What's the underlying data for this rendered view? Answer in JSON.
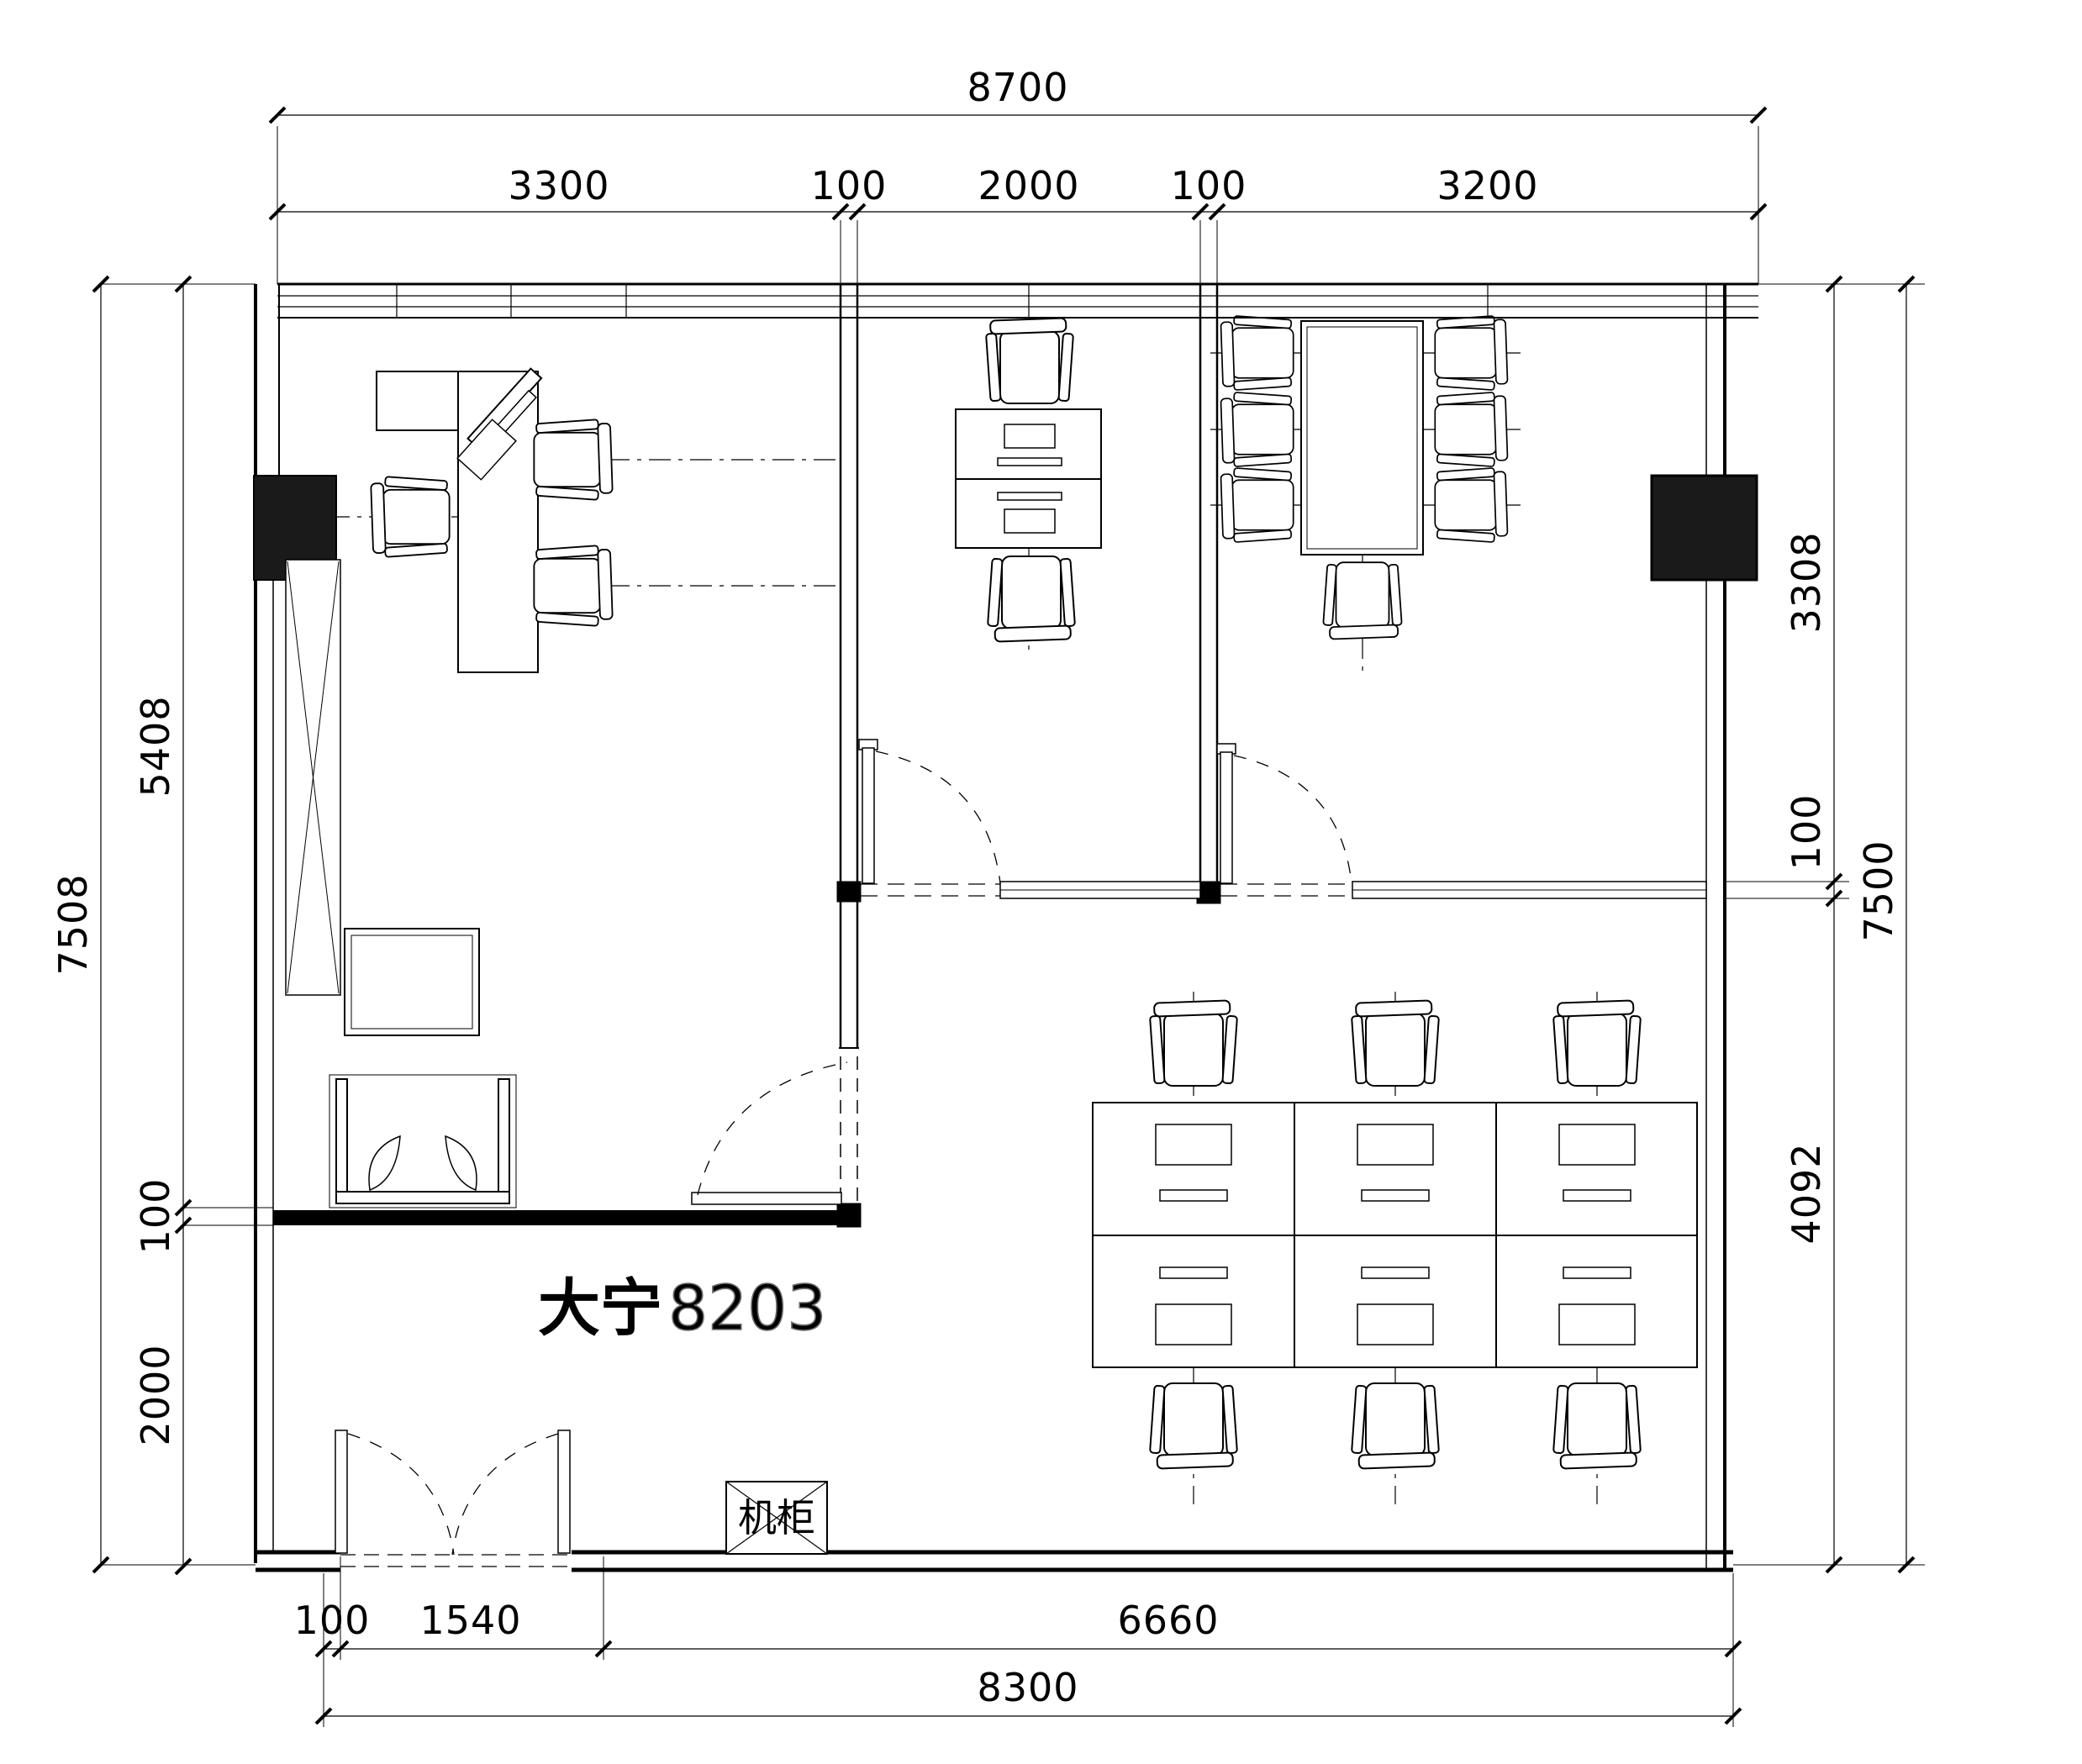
{
  "drawing": {
    "room_label_bold": "大宁",
    "room_label_light": "8203",
    "cabinet_label": "机柜",
    "colors": {
      "line": "#000000",
      "background": "#ffffff",
      "column_fill": "#1a1a1a",
      "light_label": "#9a9a9a"
    },
    "dimensions": {
      "top": {
        "overall": "8700",
        "segments": [
          "3300",
          "100",
          "2000",
          "100",
          "3200"
        ]
      },
      "left": {
        "overall": "7508",
        "segments": [
          "5408",
          "100",
          "2000"
        ]
      },
      "right": {
        "overall": "7500",
        "segments": [
          "3308",
          "100",
          "4092"
        ]
      },
      "bottom": {
        "segments": [
          "100",
          "1540",
          "6660"
        ],
        "overall": "8300"
      }
    }
  }
}
